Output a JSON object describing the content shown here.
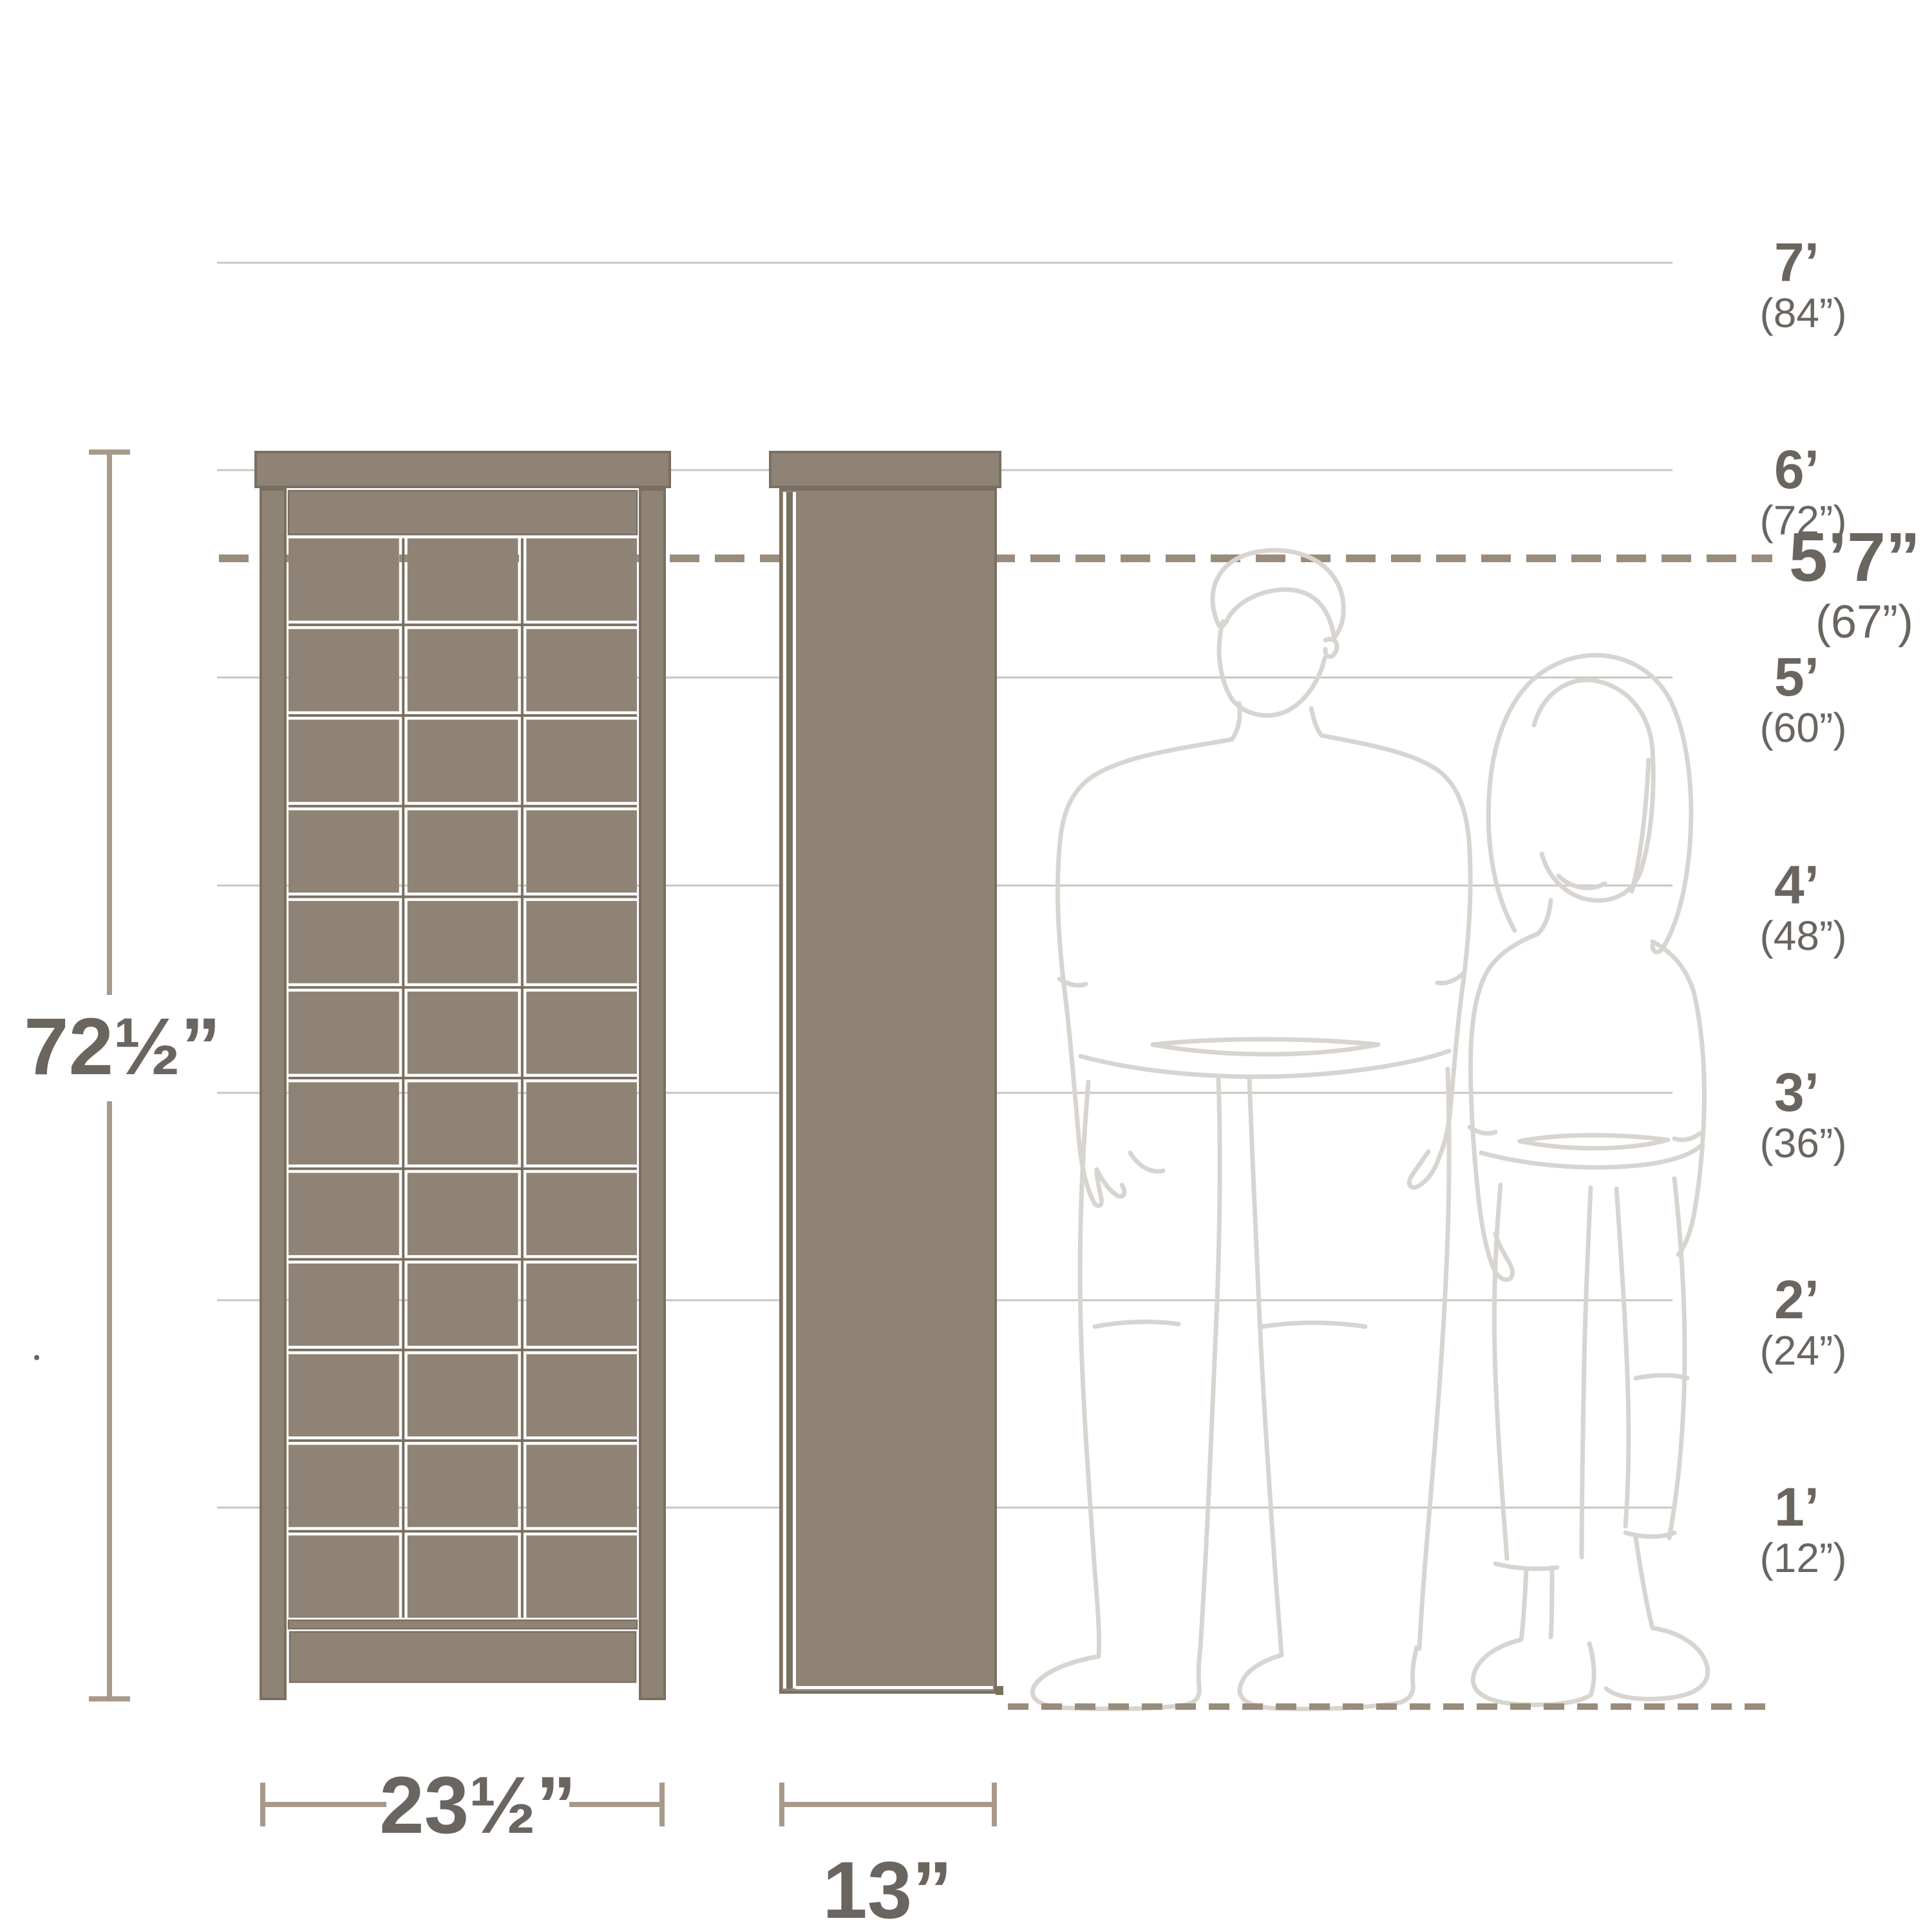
{
  "diagram": {
    "product": {
      "height_label": "72½”",
      "width_label": "23½”",
      "depth_label": "13”"
    },
    "person_height": {
      "feet": "5’7”",
      "inches": "(67”)"
    },
    "scale_marks": [
      {
        "feet": "7’",
        "inches": "(84”)"
      },
      {
        "feet": "6’",
        "inches": "(72”)"
      },
      {
        "feet": "5’",
        "inches": "(60”)"
      },
      {
        "feet": "4’",
        "inches": "(48”)"
      },
      {
        "feet": "3’",
        "inches": "(36”)"
      },
      {
        "feet": "2’",
        "inches": "(24”)"
      },
      {
        "feet": "1’",
        "inches": "(12”)"
      }
    ],
    "colors": {
      "cabinet_fill": "#8f8376",
      "cabinet_outline": "#7a7061",
      "grid_line": "#c9c5c1",
      "dashed_line": "#9a8c7c",
      "dimension_line": "#a79a8a",
      "text": "#6b6560",
      "figure_line": "#d8d5d1",
      "background": "#ffffff"
    }
  }
}
